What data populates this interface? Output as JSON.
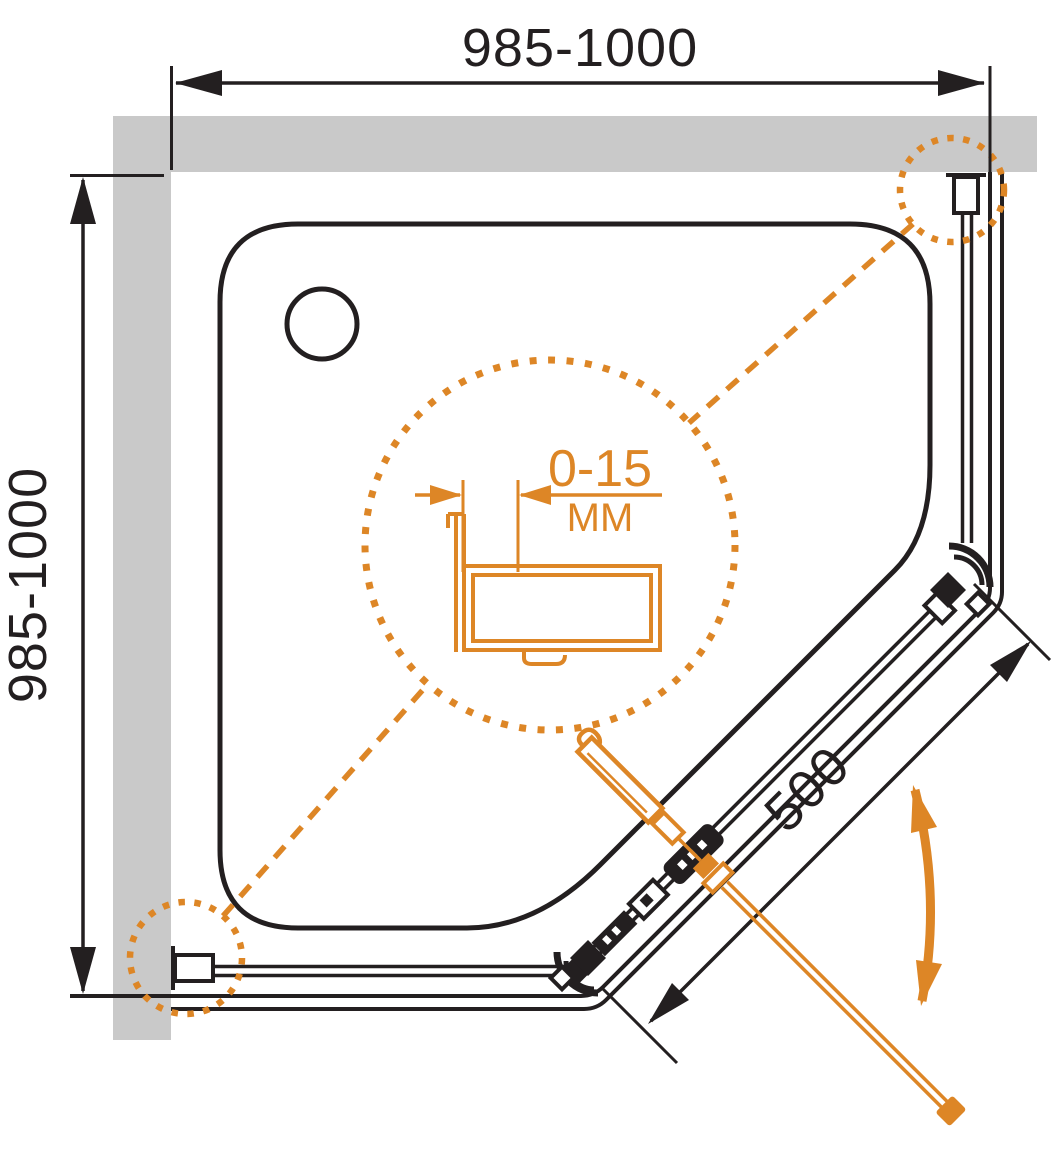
{
  "drawing": {
    "kind": "shower-enclosure-plan-view",
    "dimensions": {
      "top_width": "985-1000",
      "left_height": "985-1000",
      "door_diagonal": "500",
      "detail_adjustment_range": "0-15",
      "detail_unit": "ММ"
    }
  },
  "colors": {
    "line": "#231f20",
    "accent": "#dd8626",
    "wall": "#c9c9c9",
    "bg": "#ffffff"
  }
}
